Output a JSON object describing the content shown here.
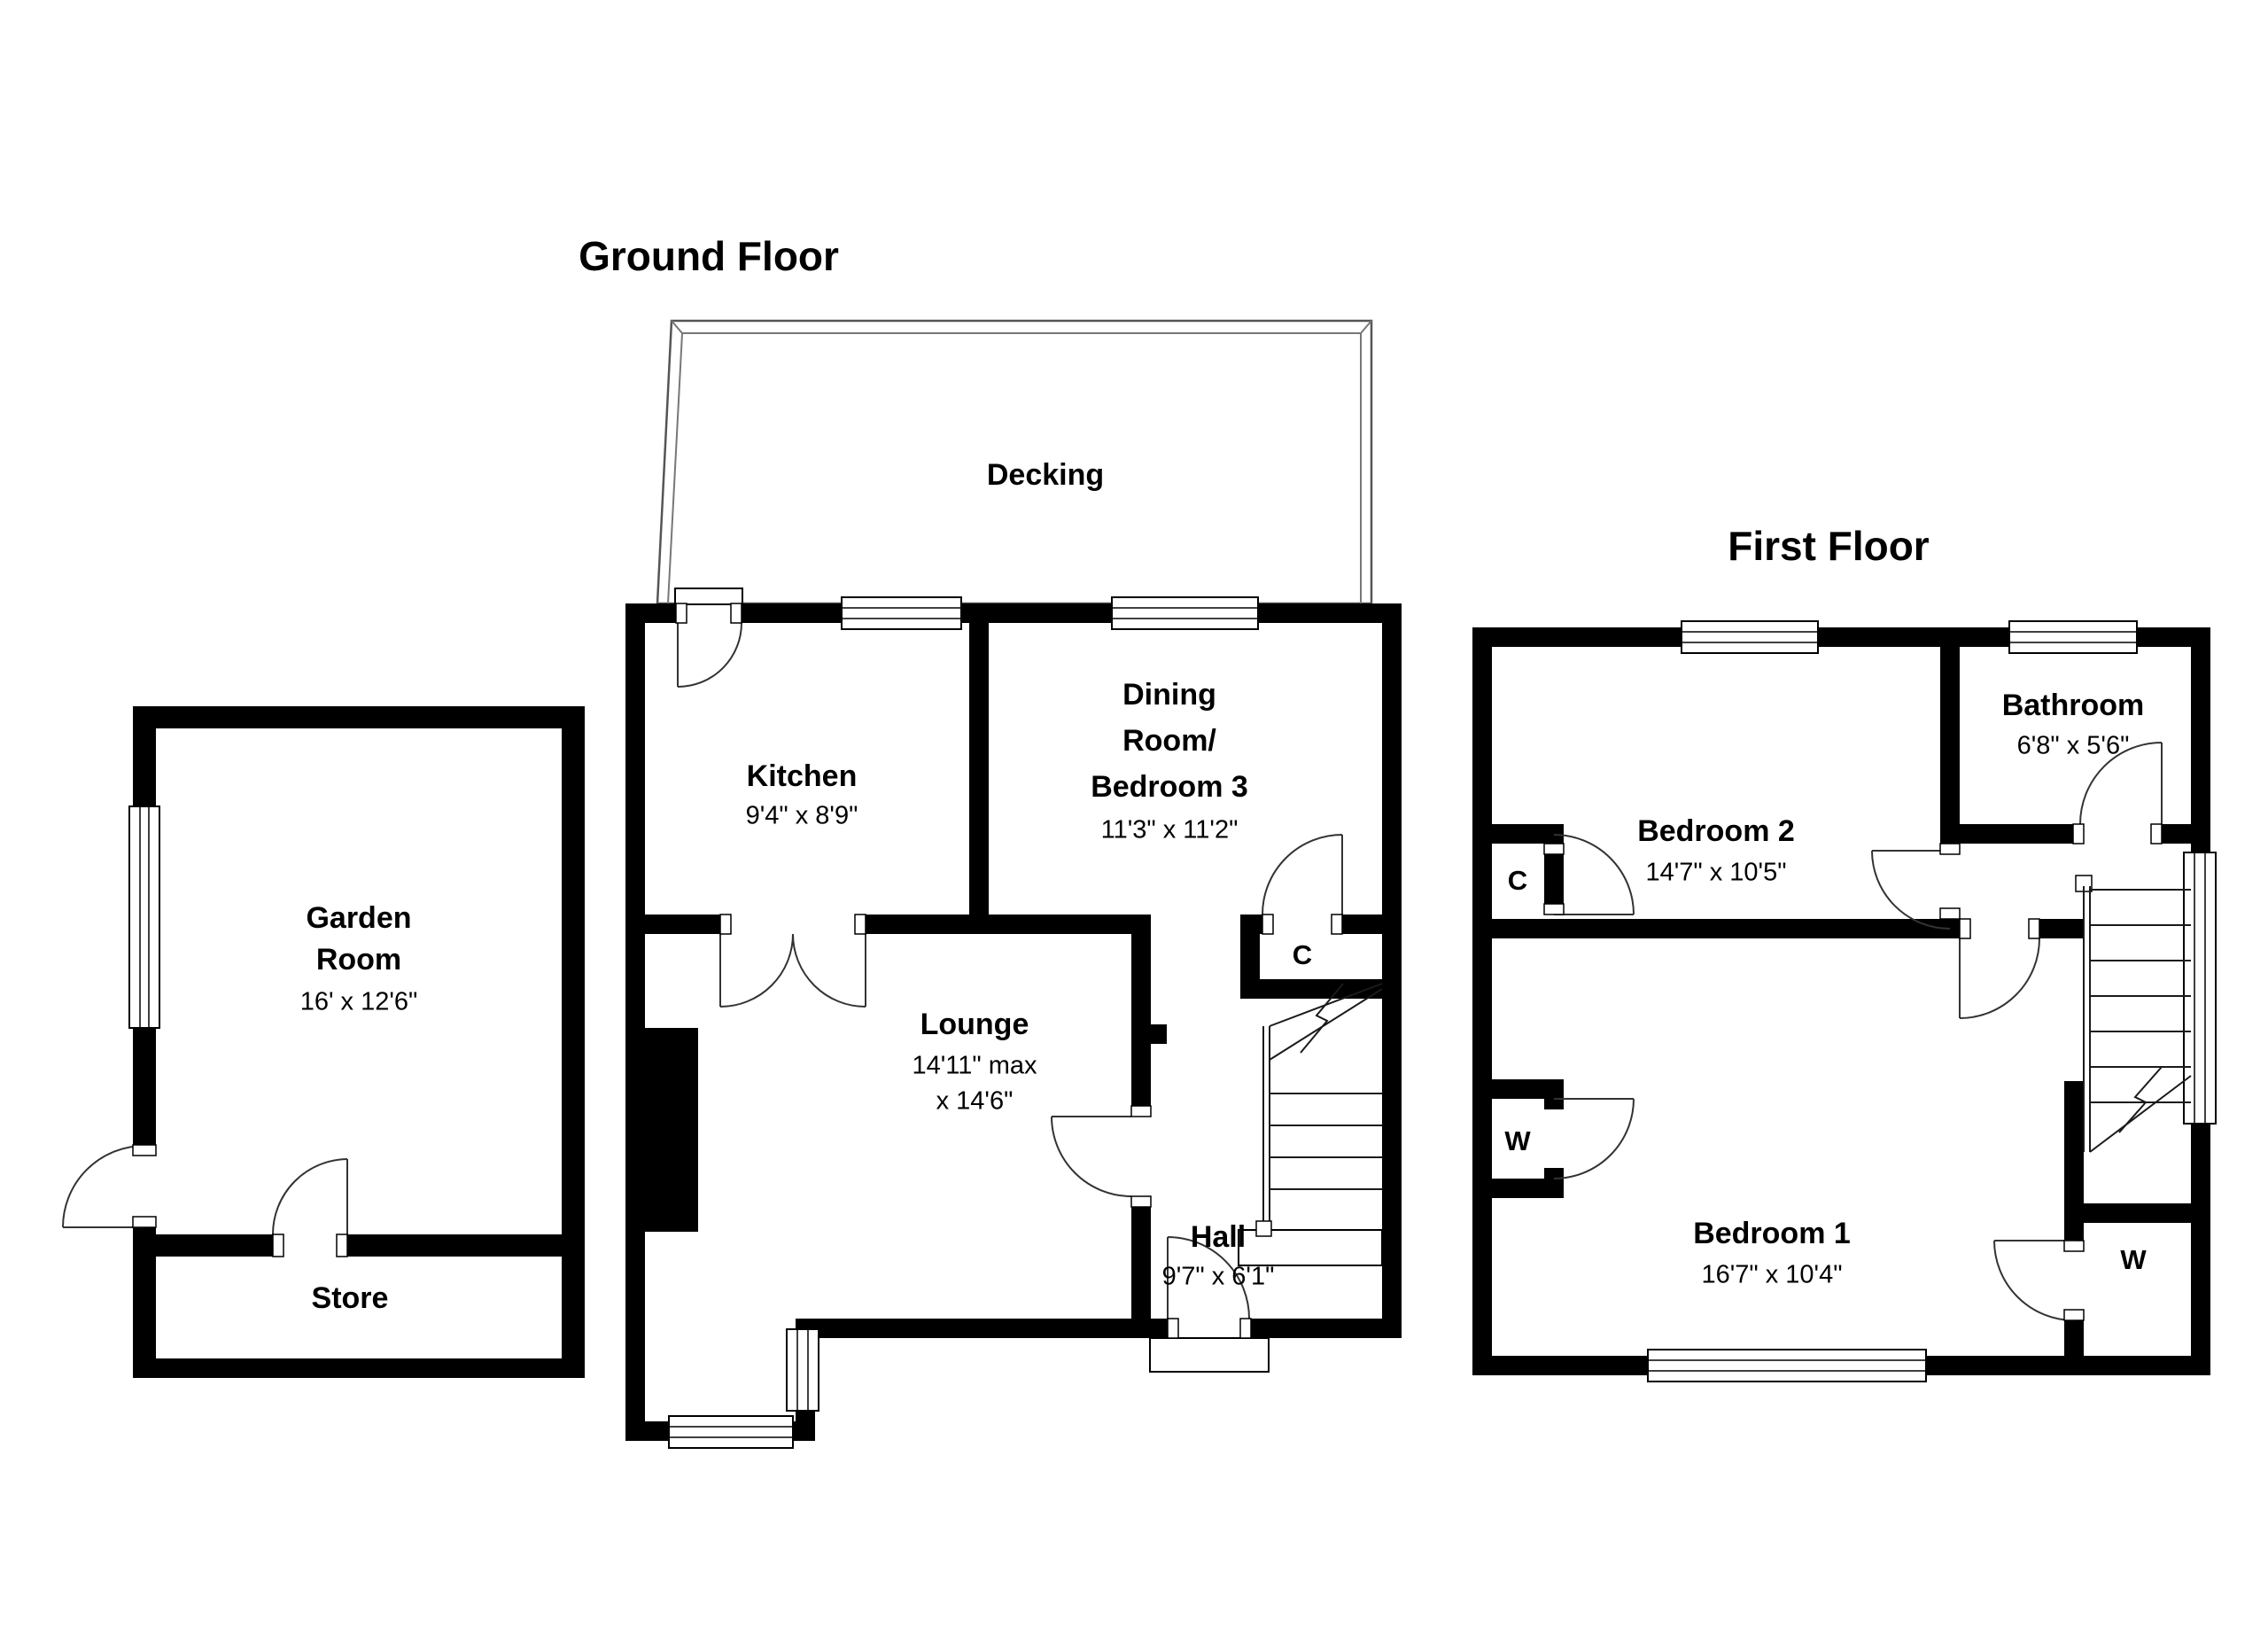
{
  "titles": {
    "ground_floor": "Ground Floor",
    "first_floor": "First Floor"
  },
  "ground": {
    "decking": {
      "label": "Decking"
    },
    "kitchen": {
      "name": "Kitchen",
      "dims": "9'4\" x 8'9\""
    },
    "dining": {
      "line1": "Dining",
      "line2": "Room/",
      "line3": "Bedroom 3",
      "dims": "11'3\" x 11'2\""
    },
    "lounge": {
      "name": "Lounge",
      "dims_line1": "14'11\" max",
      "dims_line2": "x 14'6\""
    },
    "hall": {
      "name": "Hall",
      "dims": "9'7\" x 6'1\""
    },
    "closet": {
      "label": "C"
    },
    "garden_room": {
      "line1": "Garden",
      "line2": "Room",
      "dims": "16' x 12'6\""
    },
    "store": {
      "name": "Store"
    }
  },
  "first": {
    "bedroom2": {
      "name": "Bedroom 2",
      "dims": "14'7\" x 10'5\""
    },
    "bathroom": {
      "name": "Bathroom",
      "dims": "6'8\" x 5'6\""
    },
    "bedroom1": {
      "name": "Bedroom 1",
      "dims": "16'7\" x 10'4\""
    },
    "closet": {
      "label": "C"
    },
    "wardrobe_left": {
      "label": "W"
    },
    "wardrobe_right": {
      "label": "W"
    }
  },
  "colors": {
    "wall": "#000000",
    "background": "#ffffff"
  }
}
